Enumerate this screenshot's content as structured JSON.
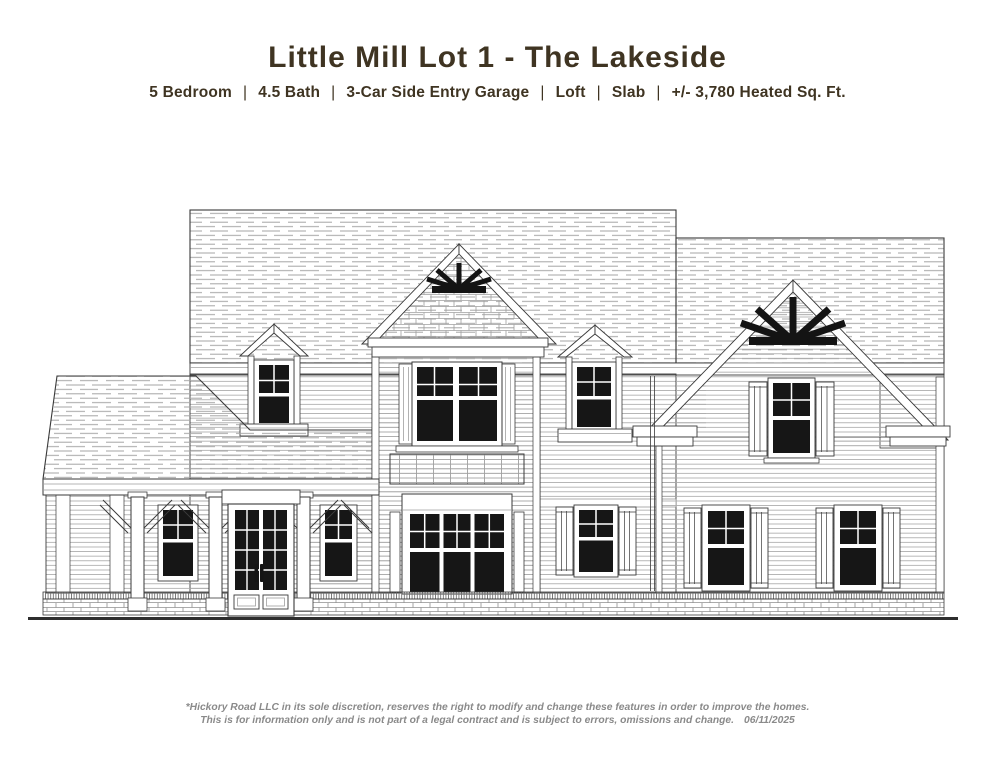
{
  "header": {
    "title": "Little Mill Lot 1 - The Lakeside",
    "separator": "|",
    "specs": [
      {
        "label": "5 Bedroom"
      },
      {
        "label": "4.5 Bath"
      },
      {
        "label": "3-Car Side Entry Garage"
      },
      {
        "label": "Loft"
      },
      {
        "label": "Slab"
      },
      {
        "label": "+/- 3,780 Heated Sq. Ft."
      }
    ],
    "text_color": "#3f3422"
  },
  "drawing": {
    "ink_color": "#3a3a3a",
    "texture_color": "#9f9f9f",
    "glass_color": "#161616",
    "ornament_color": "#141414",
    "paper_color": "#ffffff"
  },
  "footer": {
    "line1": "*Hickory Road LLC in its sole discretion, reserves the right to modify and change these features in order to improve the homes.",
    "line2": "This is for information only and is not part of a legal contract and is subject to errors, omissions and change.",
    "date": "06/11/2025",
    "text_color": "#8a8a8a"
  }
}
